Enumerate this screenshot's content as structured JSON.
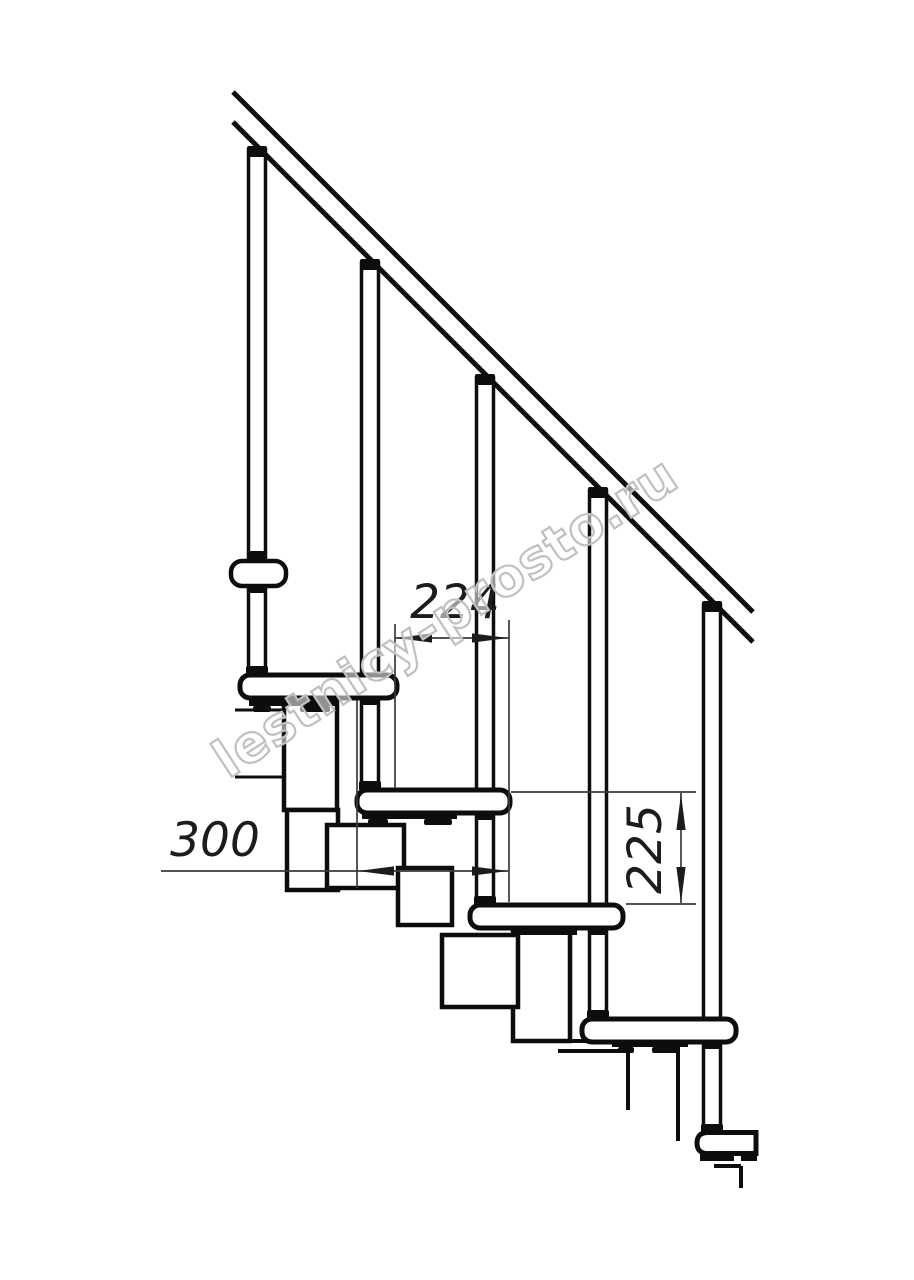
{
  "drawing": {
    "type": "technical-drawing",
    "subject": "modular staircase side-view fragment with handrail, balusters, treads and support modules",
    "background_color": "#ffffff",
    "line_color": "#0d0d0d",
    "dim_line_color": "#3a3a3a",
    "treads_visible": 6,
    "balusters_visible": 5
  },
  "dimensions": {
    "run": {
      "label": "224",
      "orientation": "horizontal"
    },
    "step_length": {
      "label": "300",
      "orientation": "horizontal"
    },
    "rise": {
      "label": "225",
      "orientation": "vertical"
    }
  },
  "watermark": {
    "text": "lestnicy-prosto.ru",
    "color": "#c0c0c0"
  }
}
